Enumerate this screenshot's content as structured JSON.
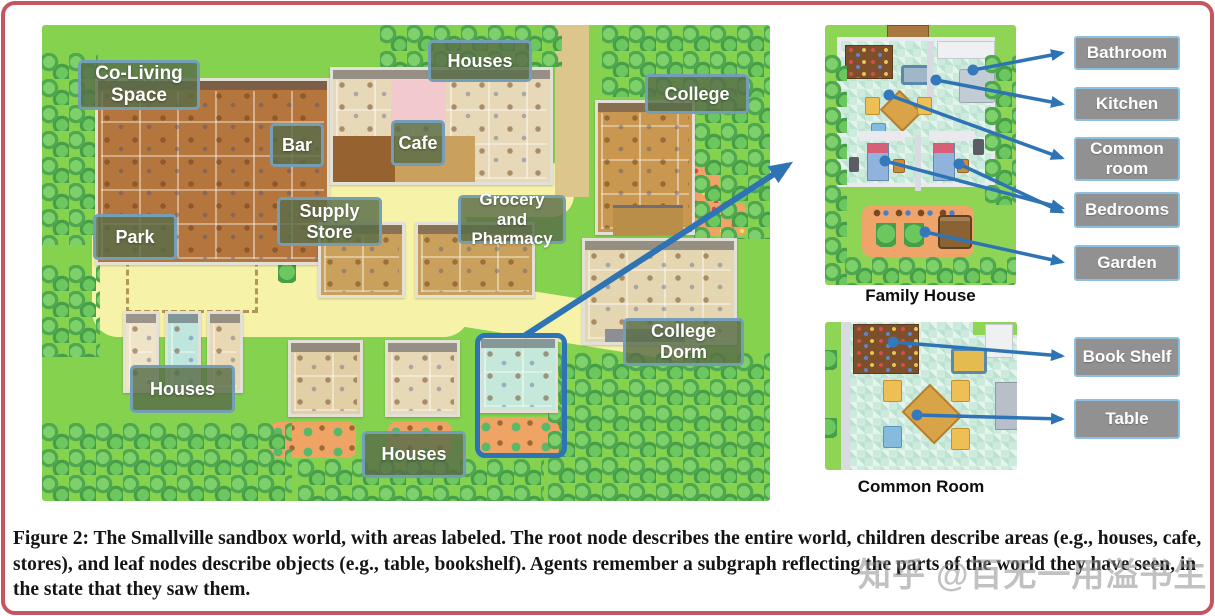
{
  "map": {
    "labels": [
      {
        "id": "co-living-space",
        "text": "Co-Living Space"
      },
      {
        "id": "houses-top",
        "text": "Houses"
      },
      {
        "id": "bar",
        "text": "Bar"
      },
      {
        "id": "cafe",
        "text": "Cafe"
      },
      {
        "id": "college",
        "text": "College"
      },
      {
        "id": "supply-store",
        "text": "Supply Store"
      },
      {
        "id": "grocery-pharmacy",
        "text": "Grocery and Pharmacy"
      },
      {
        "id": "park",
        "text": "Park"
      },
      {
        "id": "college-dorm",
        "text": "College Dorm"
      },
      {
        "id": "houses-bottom-left",
        "text": "Houses"
      },
      {
        "id": "houses-bottom-middle",
        "text": "Houses"
      }
    ]
  },
  "insets": {
    "family_house": {
      "caption": "Family House",
      "labels": [
        "Bathroom",
        "Kitchen",
        "Common room",
        "Bedrooms",
        "Garden"
      ]
    },
    "common_room": {
      "caption": "Common Room",
      "labels": [
        "Book Shelf",
        "Table"
      ]
    }
  },
  "caption": "Figure 2: The Smallville sandbox world, with areas labeled. The root node describes the entire world, children describe areas (e.g., houses, cafe, stores), and leaf nodes describe objects (e.g., table, bookshelf). Agents remember a subgraph reflecting the parts of the world they have seen, in the state that they saw them.",
  "watermark": "知乎 @百无一用溢书生",
  "colors": {
    "arrow": "#2e74b5",
    "grass": "#85d24e",
    "path": "#f6f2a8",
    "map_label_bg": "#586c48",
    "map_label_border": "#76a0bd",
    "inset_label_bg": "#919191",
    "inset_label_border": "#8cc0e0",
    "frame_border": "#c5565e"
  }
}
